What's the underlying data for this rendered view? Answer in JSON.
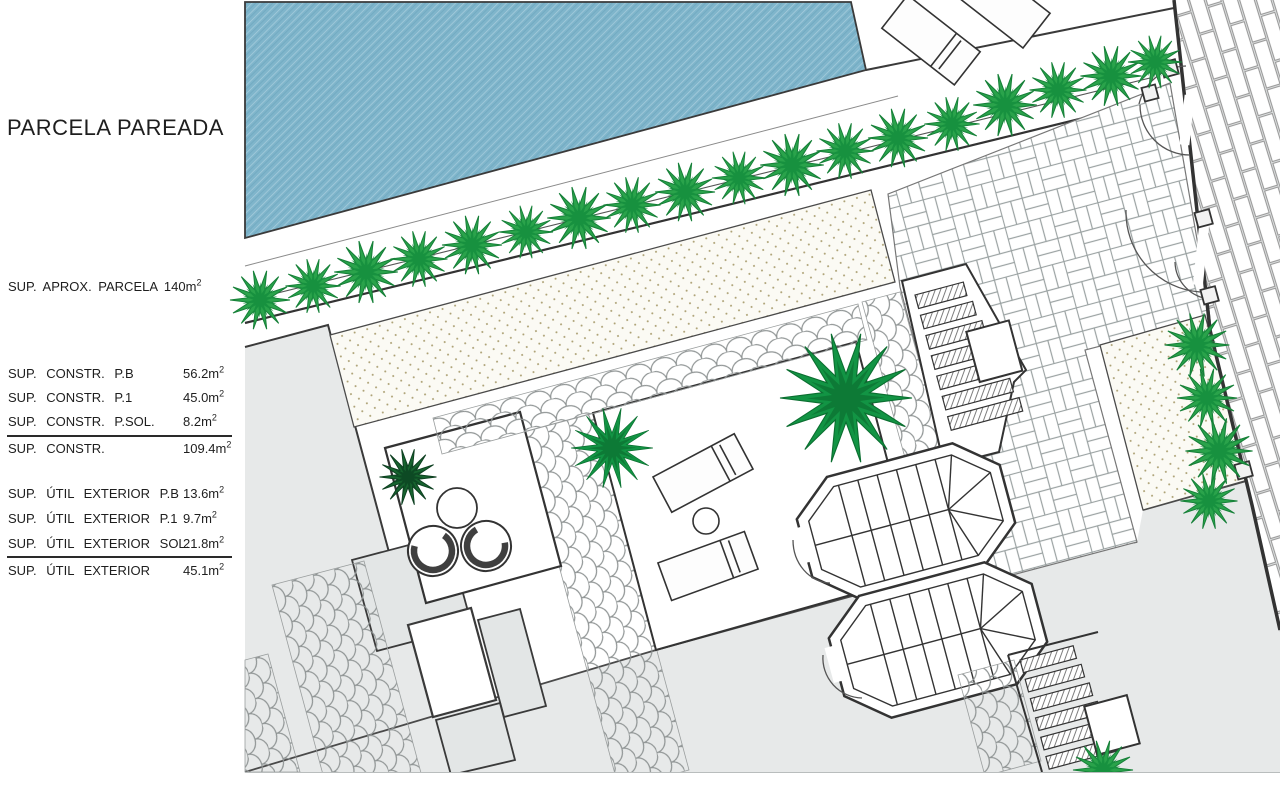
{
  "legend": {
    "title": "PARCELA PAREADA",
    "parcel_note": {
      "text": "SUP. APROX. PARCELA 140m",
      "sup": "2"
    },
    "construction_rows": [
      {
        "label": "SUP. CONSTR. P.B",
        "value": "56.2m",
        "sup": "2"
      },
      {
        "label": "SUP. CONSTR. P.1",
        "value": "45.0m",
        "sup": "2"
      },
      {
        "label": "SUP. CONSTR. P.SOL.",
        "value": "8.2m",
        "sup": "2"
      },
      {
        "label": "SUP. CONSTR.",
        "value": "109.4m",
        "sup": "2"
      }
    ],
    "exterior_rows": [
      {
        "label": "SUP. ÚTIL EXTERIOR P.B",
        "value": "13.6m",
        "sup": "2"
      },
      {
        "label": "SUP. ÚTIL EXTERIOR P.1",
        "value": "9.7m",
        "sup": "2"
      },
      {
        "label": "SUP. ÚTIL EXTERIOR SOL.",
        "value": "21.8m",
        "sup": "2"
      },
      {
        "label": "SUP. ÚTIL EXTERIOR",
        "value": "45.1m",
        "sup": "2"
      }
    ]
  },
  "plan": {
    "colors": {
      "pool_water": "#7fb5cb",
      "shrub_green": "#2aa34b",
      "palm_green": "#129444",
      "gray_area": "#e7e9e9",
      "line_dark": "#333333",
      "gravel_bed_bg": "#fbfaf4"
    },
    "feature_names": [
      "swimming-pool",
      "hedge-row",
      "gravel-bed-top",
      "gravel-bed-right",
      "basketweave-paving",
      "cobblestone-paths",
      "terrace-with-loungers",
      "patio-with-chairs",
      "octagonal-staircase-upper",
      "octagonal-staircase-lower",
      "exterior-steps",
      "perimeter-wall-with-gates",
      "brick-sidewalk",
      "palm-trees"
    ]
  }
}
